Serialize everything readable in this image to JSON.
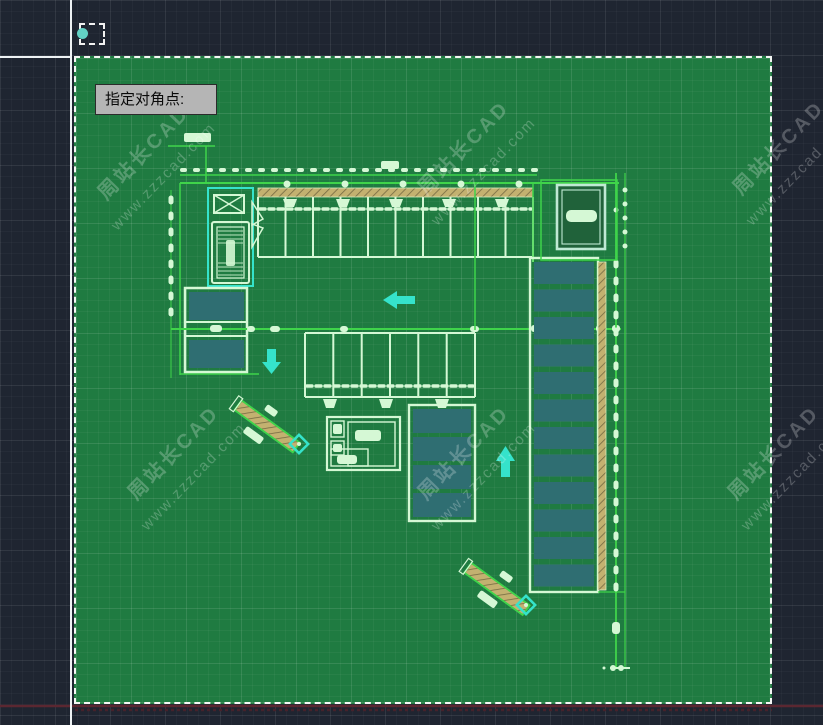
{
  "prompt": {
    "tooltip": "指定对角点:"
  },
  "watermark": {
    "line1": "周站长CAD",
    "line2": "www.zzzcad.com"
  },
  "colors": {
    "canvas_background": "#1f2531",
    "selection_fill": "#1f7b41",
    "selection_border": "#f4f7f4",
    "line_bright_green": "#3fd44a",
    "line_pale_green": "#d5f8d5",
    "highlight_teal": "#35e3cb",
    "parking_fill_teal": "#2f6e72",
    "hatch_tan": "#c3b170",
    "red_baseline": "#5b2731",
    "tooltip_background": "#b5b5b5",
    "crosshair": "#eef2f4"
  }
}
